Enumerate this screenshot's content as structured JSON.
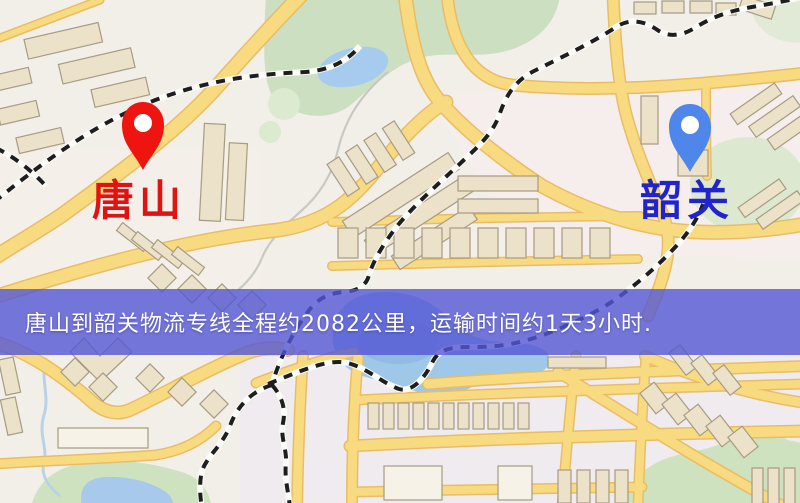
{
  "map_image": {
    "origin_marker": {
      "label": "唐山",
      "pin_style": "red-pin"
    },
    "destination_marker": {
      "label": "韶关",
      "pin_style": "blue-pin"
    },
    "banner": {
      "text": "唐山到韶关物流专线全程约2082公里，运输时间约1天3小时."
    },
    "route": {
      "from": "唐山",
      "to": "韶关",
      "distance": "约2082公里",
      "duration": "约1天3小时"
    },
    "colors": {
      "red_pin": "#ee1410",
      "blue_pin": "#4f86ea",
      "origin_label": "#e01212",
      "destination_label": "#2124cc",
      "banner_bg": "#5456d5",
      "banner_text": "#ffffff",
      "road_fill": "#f8da80",
      "water": "#9ec7e8",
      "park_green": "#ccdfc0"
    }
  }
}
